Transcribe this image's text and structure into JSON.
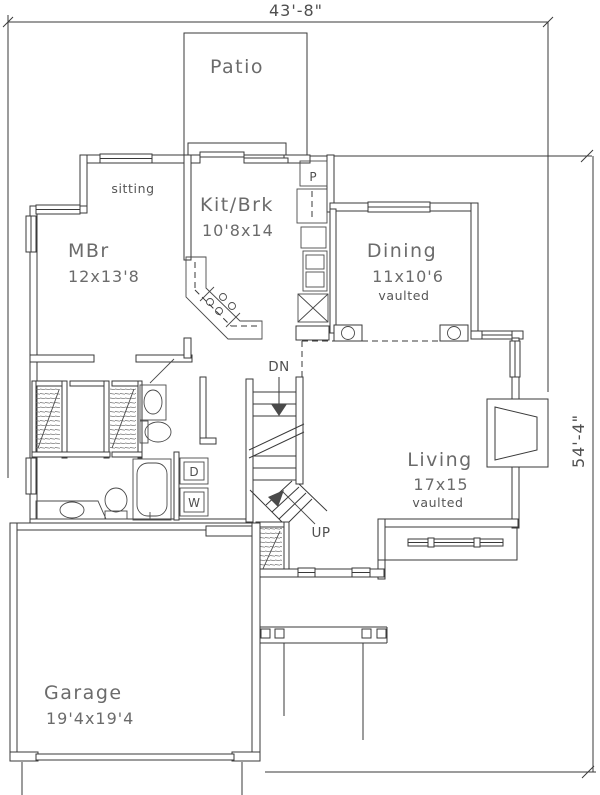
{
  "title": "House floor plan",
  "dimensions": {
    "width": "43'-8\"",
    "height": "54'-4\""
  },
  "rooms": {
    "patio": {
      "label": "Patio"
    },
    "sitting": {
      "label": "sitting"
    },
    "kitchen": {
      "label": "Kit/Brk",
      "size": "10'8x14"
    },
    "master": {
      "label": "MBr",
      "size": "12x13'8"
    },
    "dining": {
      "label": "Dining",
      "size": "11x10'6",
      "note": "vaulted"
    },
    "living": {
      "label": "Living",
      "size": "17x15",
      "note": "vaulted"
    },
    "garage": {
      "label": "Garage",
      "size": "19'4x19'4"
    }
  },
  "markers": {
    "stairs_down": "DN",
    "stairs_up": "UP",
    "pantry": "P",
    "dryer": "D",
    "washer": "W"
  },
  "colors": {
    "line": "#3a3a3a",
    "text": "#5f5f5f",
    "background": "#ffffff"
  }
}
